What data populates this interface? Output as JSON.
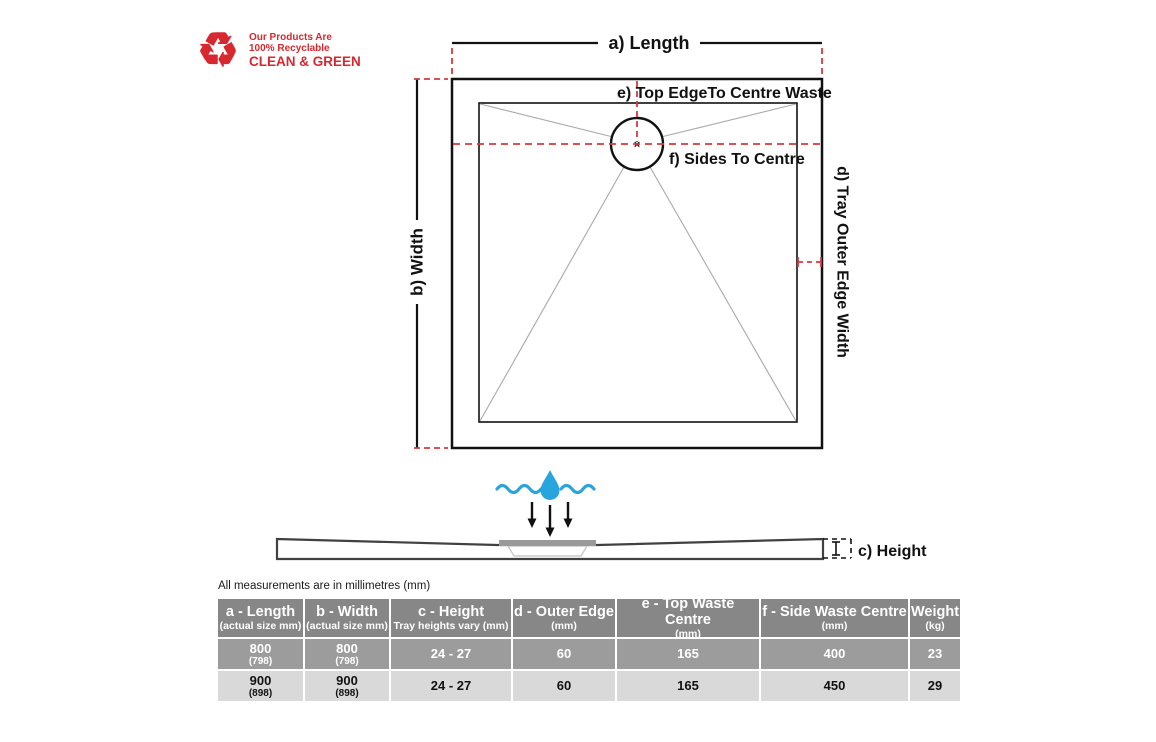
{
  "logo": {
    "line1": "Our Products Are",
    "line2": "100% Recyclable",
    "line3": "CLEAN & GREEN",
    "recycle_glyph": "♻"
  },
  "diagram": {
    "labels": {
      "a": "a) Length",
      "b": "b) Width",
      "c": "c) Height",
      "d": "d) Tray Outer Edge Width",
      "e": "e) Top EdgeTo Centre Waste",
      "f": "f) Sides To Centre"
    },
    "waste_centre_marker": "×"
  },
  "note": "All measurements are in millimetres (mm)",
  "table": {
    "columns": [
      {
        "title": "a - Length",
        "sub": "(actual size mm)"
      },
      {
        "title": "b - Width",
        "sub": "(actual size mm)"
      },
      {
        "title": "c - Height",
        "sub": "Tray heights vary (mm)"
      },
      {
        "title": "d - Outer Edge",
        "sub": "(mm)"
      },
      {
        "title": "e - Top Waste Centre",
        "sub": "(mm)"
      },
      {
        "title": "f - Side Waste Centre",
        "sub": "(mm)"
      },
      {
        "title": "Weight",
        "sub": "(kg)"
      }
    ],
    "rows": [
      {
        "cells": [
          {
            "main": "800",
            "sub": "(798)"
          },
          {
            "main": "800",
            "sub": "(798)"
          },
          {
            "main": "24 - 27"
          },
          {
            "main": "60"
          },
          {
            "main": "165"
          },
          {
            "main": "400"
          },
          {
            "main": "23"
          }
        ]
      },
      {
        "cells": [
          {
            "main": "900",
            "sub": "(898)"
          },
          {
            "main": "900",
            "sub": "(898)"
          },
          {
            "main": "24 - 27"
          },
          {
            "main": "60"
          },
          {
            "main": "165"
          },
          {
            "main": "450"
          },
          {
            "main": "29"
          }
        ]
      }
    ]
  },
  "colors": {
    "brand_red": "#d7282f",
    "dimension_red": "#d9383c",
    "water_blue": "#29a5dd",
    "table_header_bg": "#878787",
    "table_row_dark_bg": "#9c9c9c",
    "table_row_light_bg": "#d9d9d9",
    "drain_gray": "#9a9a9a"
  }
}
